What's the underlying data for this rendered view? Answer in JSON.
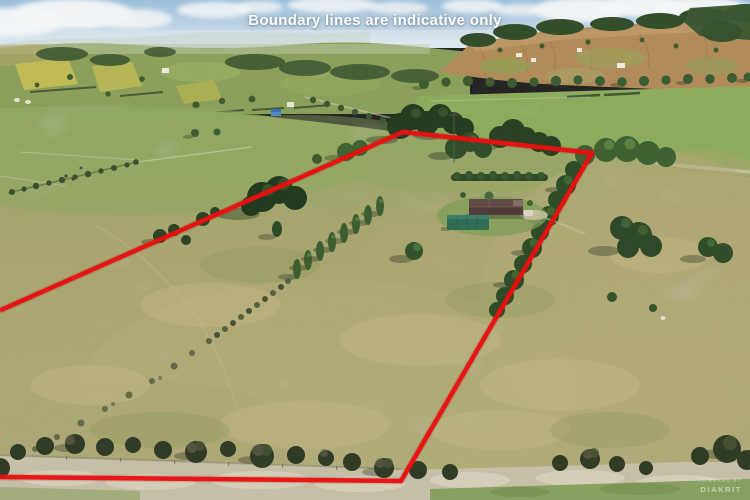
{
  "overlay": {
    "disclaimer": "Boundary lines are indicative only"
  },
  "watermark": {
    "line1": "POWERED BY",
    "line2": "DIAKRIT"
  },
  "boundary": {
    "color": "#e81111",
    "stroke_width": "4.5",
    "svg_points": "0,310.5 403,132 592,153 401,481 0,477"
  },
  "scene": {
    "type": "aerial-drone-photo",
    "subject": "rural lifestyle property outlined in red among paddocks and shelterbelt trees",
    "palette": {
      "sky": "#9cbfdb",
      "cloud": "#f6f8f9",
      "green_field": "#85a557",
      "dry_pasture": "#aaa671",
      "brown_hill": "#b18a58",
      "tree_dark": "#2c4a25",
      "house_roof": "#4e3a37",
      "shed_roof": "#2f6b54",
      "blue_shed": "#4b87cb",
      "gravel": "#c6bfa8",
      "boundary_red": "#e81111"
    }
  }
}
